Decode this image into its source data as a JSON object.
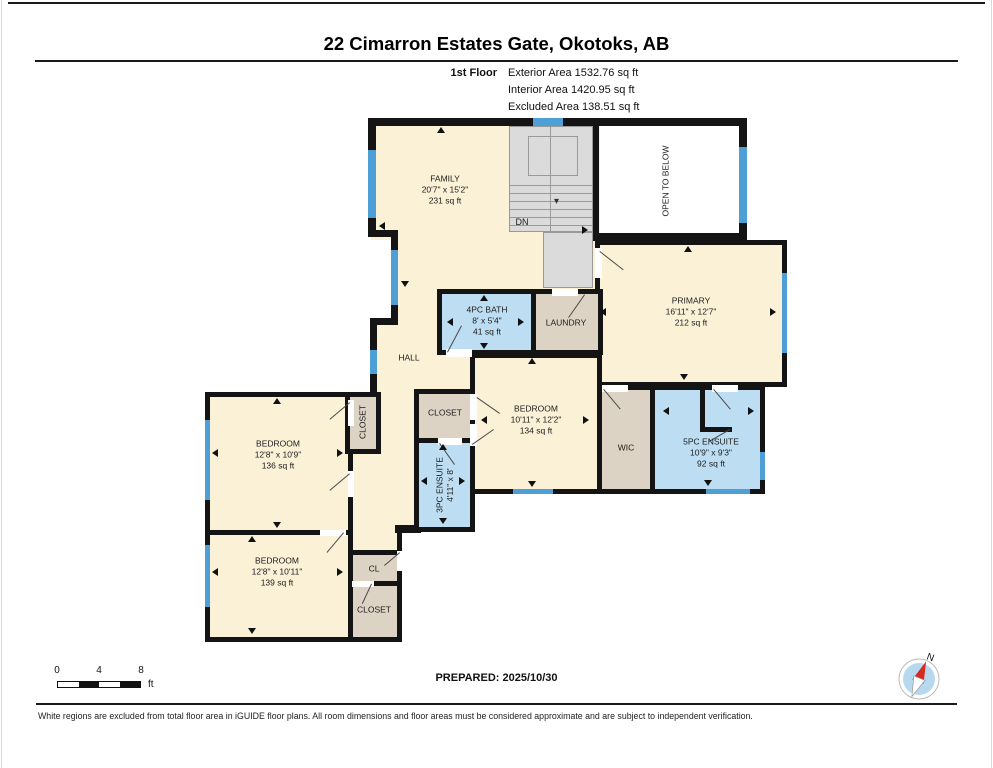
{
  "page": {
    "title": "22 Cimarron Estates Gate, Okotoks, AB"
  },
  "floor_info": {
    "floor": "1st Floor",
    "exterior": "Exterior Area 1532.76 sq ft",
    "interior": "Interior Area 1420.95 sq ft",
    "excluded": "Excluded Area 138.51 sq ft"
  },
  "rooms": {
    "family": {
      "name": "FAMILY",
      "dims": "20'7\" x 15'2\"",
      "area": "231 sq ft"
    },
    "open_to_below": {
      "name": "OPEN TO BELOW"
    },
    "stairs": {
      "label": "DN",
      "arrow": "▾"
    },
    "primary": {
      "name": "PRIMARY",
      "dims": "16'11\" x 12'7\"",
      "area": "212 sq ft"
    },
    "bath4": {
      "name": "4PC BATH",
      "dims": "8' x 5'4\"",
      "area": "41 sq ft"
    },
    "laundry": {
      "name": "LAUNDRY"
    },
    "hall": {
      "name": "HALL"
    },
    "closet_mid": {
      "name": "CLOSET"
    },
    "ensuite3": {
      "name": "3PC ENSUITE",
      "dims": "4'11\" x 8'"
    },
    "bedroom_mid": {
      "name": "BEDROOM",
      "dims": "10'11\" x 12'2\"",
      "area": "134 sq ft"
    },
    "wic": {
      "name": "WIC"
    },
    "ensuite5": {
      "name": "5PC ENSUITE",
      "dims": "10'9\" x 9'3\"",
      "area": "92 sq ft"
    },
    "bedroom_left_top": {
      "name": "BEDROOM",
      "dims": "12'8\" x 10'9\"",
      "area": "136 sq ft"
    },
    "closet_left": {
      "name": "CLOSET"
    },
    "bedroom_left_bottom": {
      "name": "BEDROOM",
      "dims": "12'8\" x 10'11\"",
      "area": "139 sq ft"
    },
    "cl": {
      "name": "CL"
    },
    "closet_bottom": {
      "name": "CLOSET"
    }
  },
  "scale": {
    "t0": "0",
    "t1": "4",
    "t2": "8",
    "unit": "ft"
  },
  "footer": {
    "prepared": "PREPARED: 2025/10/30",
    "disclaimer": "White regions are excluded from total floor area in iGUIDE floor plans. All room dimensions and floor areas must be considered approximate and are subject to independent verification."
  },
  "compass": {
    "label": "N"
  },
  "colors": {
    "room_fill": "#FAF1D7",
    "wet_fill": "#BCDDF2",
    "closet_fill": "#DCD3C4",
    "stairs_fill": "#DBDBDB",
    "wall": "#141414",
    "window": "#4D9FD6"
  }
}
